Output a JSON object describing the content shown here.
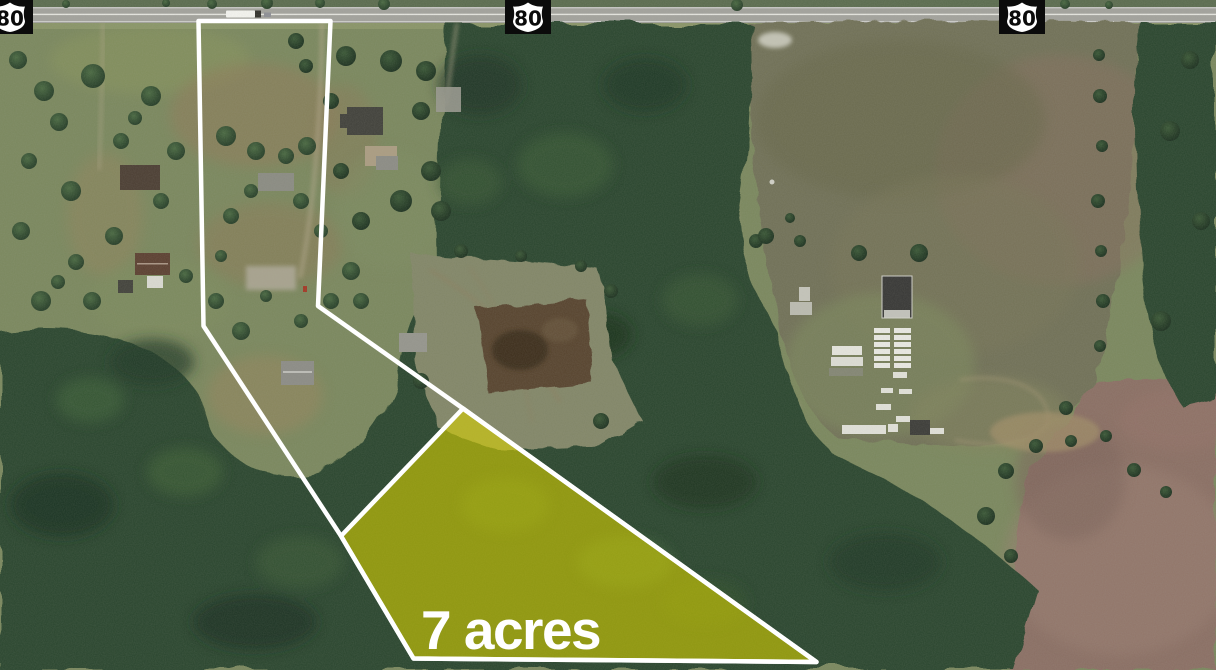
{
  "map": {
    "kind": "satellite-aerial-parcel-map",
    "highway_shields": [
      {
        "route": "80",
        "position": "left"
      },
      {
        "route": "80",
        "position": "center"
      },
      {
        "route": "80",
        "position": "right"
      }
    ],
    "parcel": {
      "area_label": "7 acres",
      "highlight_color": "#d9d300",
      "boundary_color": "#ffffff"
    }
  }
}
